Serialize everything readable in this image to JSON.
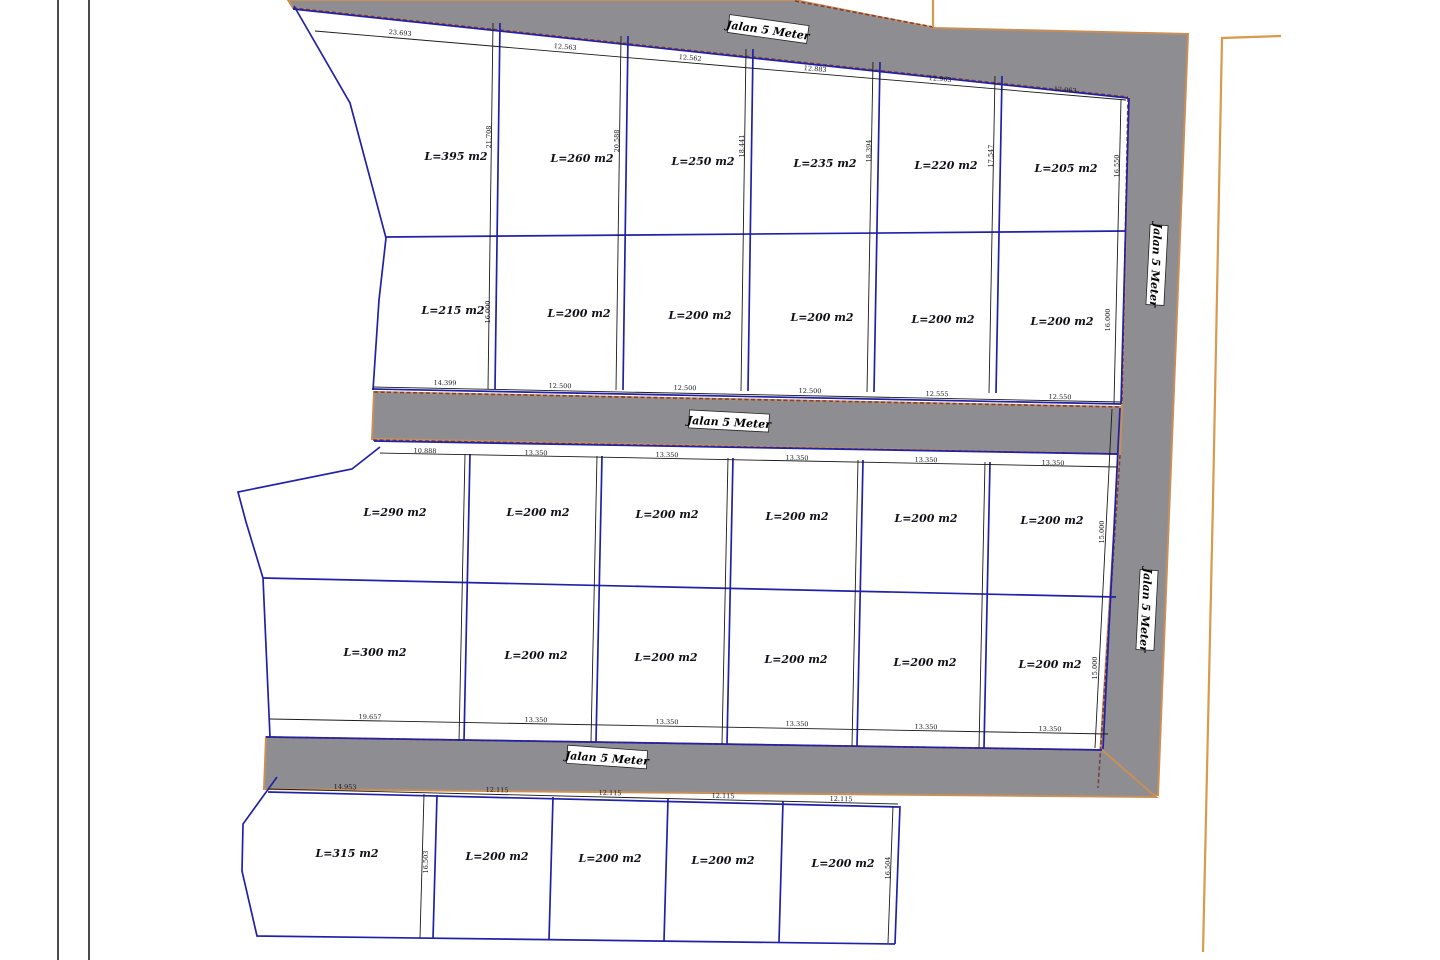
{
  "drawing": {
    "type": "land-subdivision-site-plan",
    "road_label": "Jalan 5 Meter",
    "colors": {
      "road_fill": "#8e8e92",
      "road_edge": "#c89058",
      "road_plot_edge_dashed": "#7a4040",
      "parcel_line_blue": "#2121a8",
      "dimension_line": "#1a1a1a",
      "outer_boundary_orange": "#d79a4e"
    }
  },
  "plots": {
    "row1": [
      "L=395 m2",
      "L=260 m2",
      "L=250 m2",
      "L=235 m2",
      "L=220 m2",
      "L=205 m2"
    ],
    "row2": [
      "L=215 m2",
      "L=200 m2",
      "L=200 m2",
      "L=200 m2",
      "L=200 m2",
      "L=200 m2"
    ],
    "row3": [
      "L=290 m2",
      "L=200 m2",
      "L=200 m2",
      "L=200 m2",
      "L=200 m2",
      "L=200 m2"
    ],
    "row4": [
      "L=300 m2",
      "L=200 m2",
      "L=200 m2",
      "L=200 m2",
      "L=200 m2",
      "L=200 m2"
    ],
    "row5": [
      "L=315 m2",
      "L=200 m2",
      "L=200 m2",
      "L=200 m2",
      "L=200 m2"
    ]
  },
  "dims": {
    "row1_top": [
      "23.693",
      "12.563",
      "12.562",
      "12.883",
      "12.963",
      "12.963"
    ],
    "row1_side": [
      "21.708",
      "20.588",
      "18.441",
      "18.394",
      "17.547",
      "16.550"
    ],
    "row2_bottom": [
      "14.399",
      "12.500",
      "12.500",
      "12.500",
      "12.555",
      "12.550"
    ],
    "row2_side": [
      "16.000",
      "16.000"
    ],
    "row3_top": [
      "10.888",
      "13.350",
      "13.350",
      "13.350",
      "13.350",
      "13.350"
    ],
    "row3_side": [
      "15.000"
    ],
    "row4_bottom": [
      "19.657",
      "13.350",
      "13.350",
      "13.350",
      "13.350",
      "13.350"
    ],
    "row4_side": [
      "15.000"
    ],
    "row5_top": [
      "14.953",
      "12.115",
      "12.115",
      "12.115",
      "12.115"
    ],
    "row5_side": [
      "16.503",
      "16.504"
    ]
  }
}
